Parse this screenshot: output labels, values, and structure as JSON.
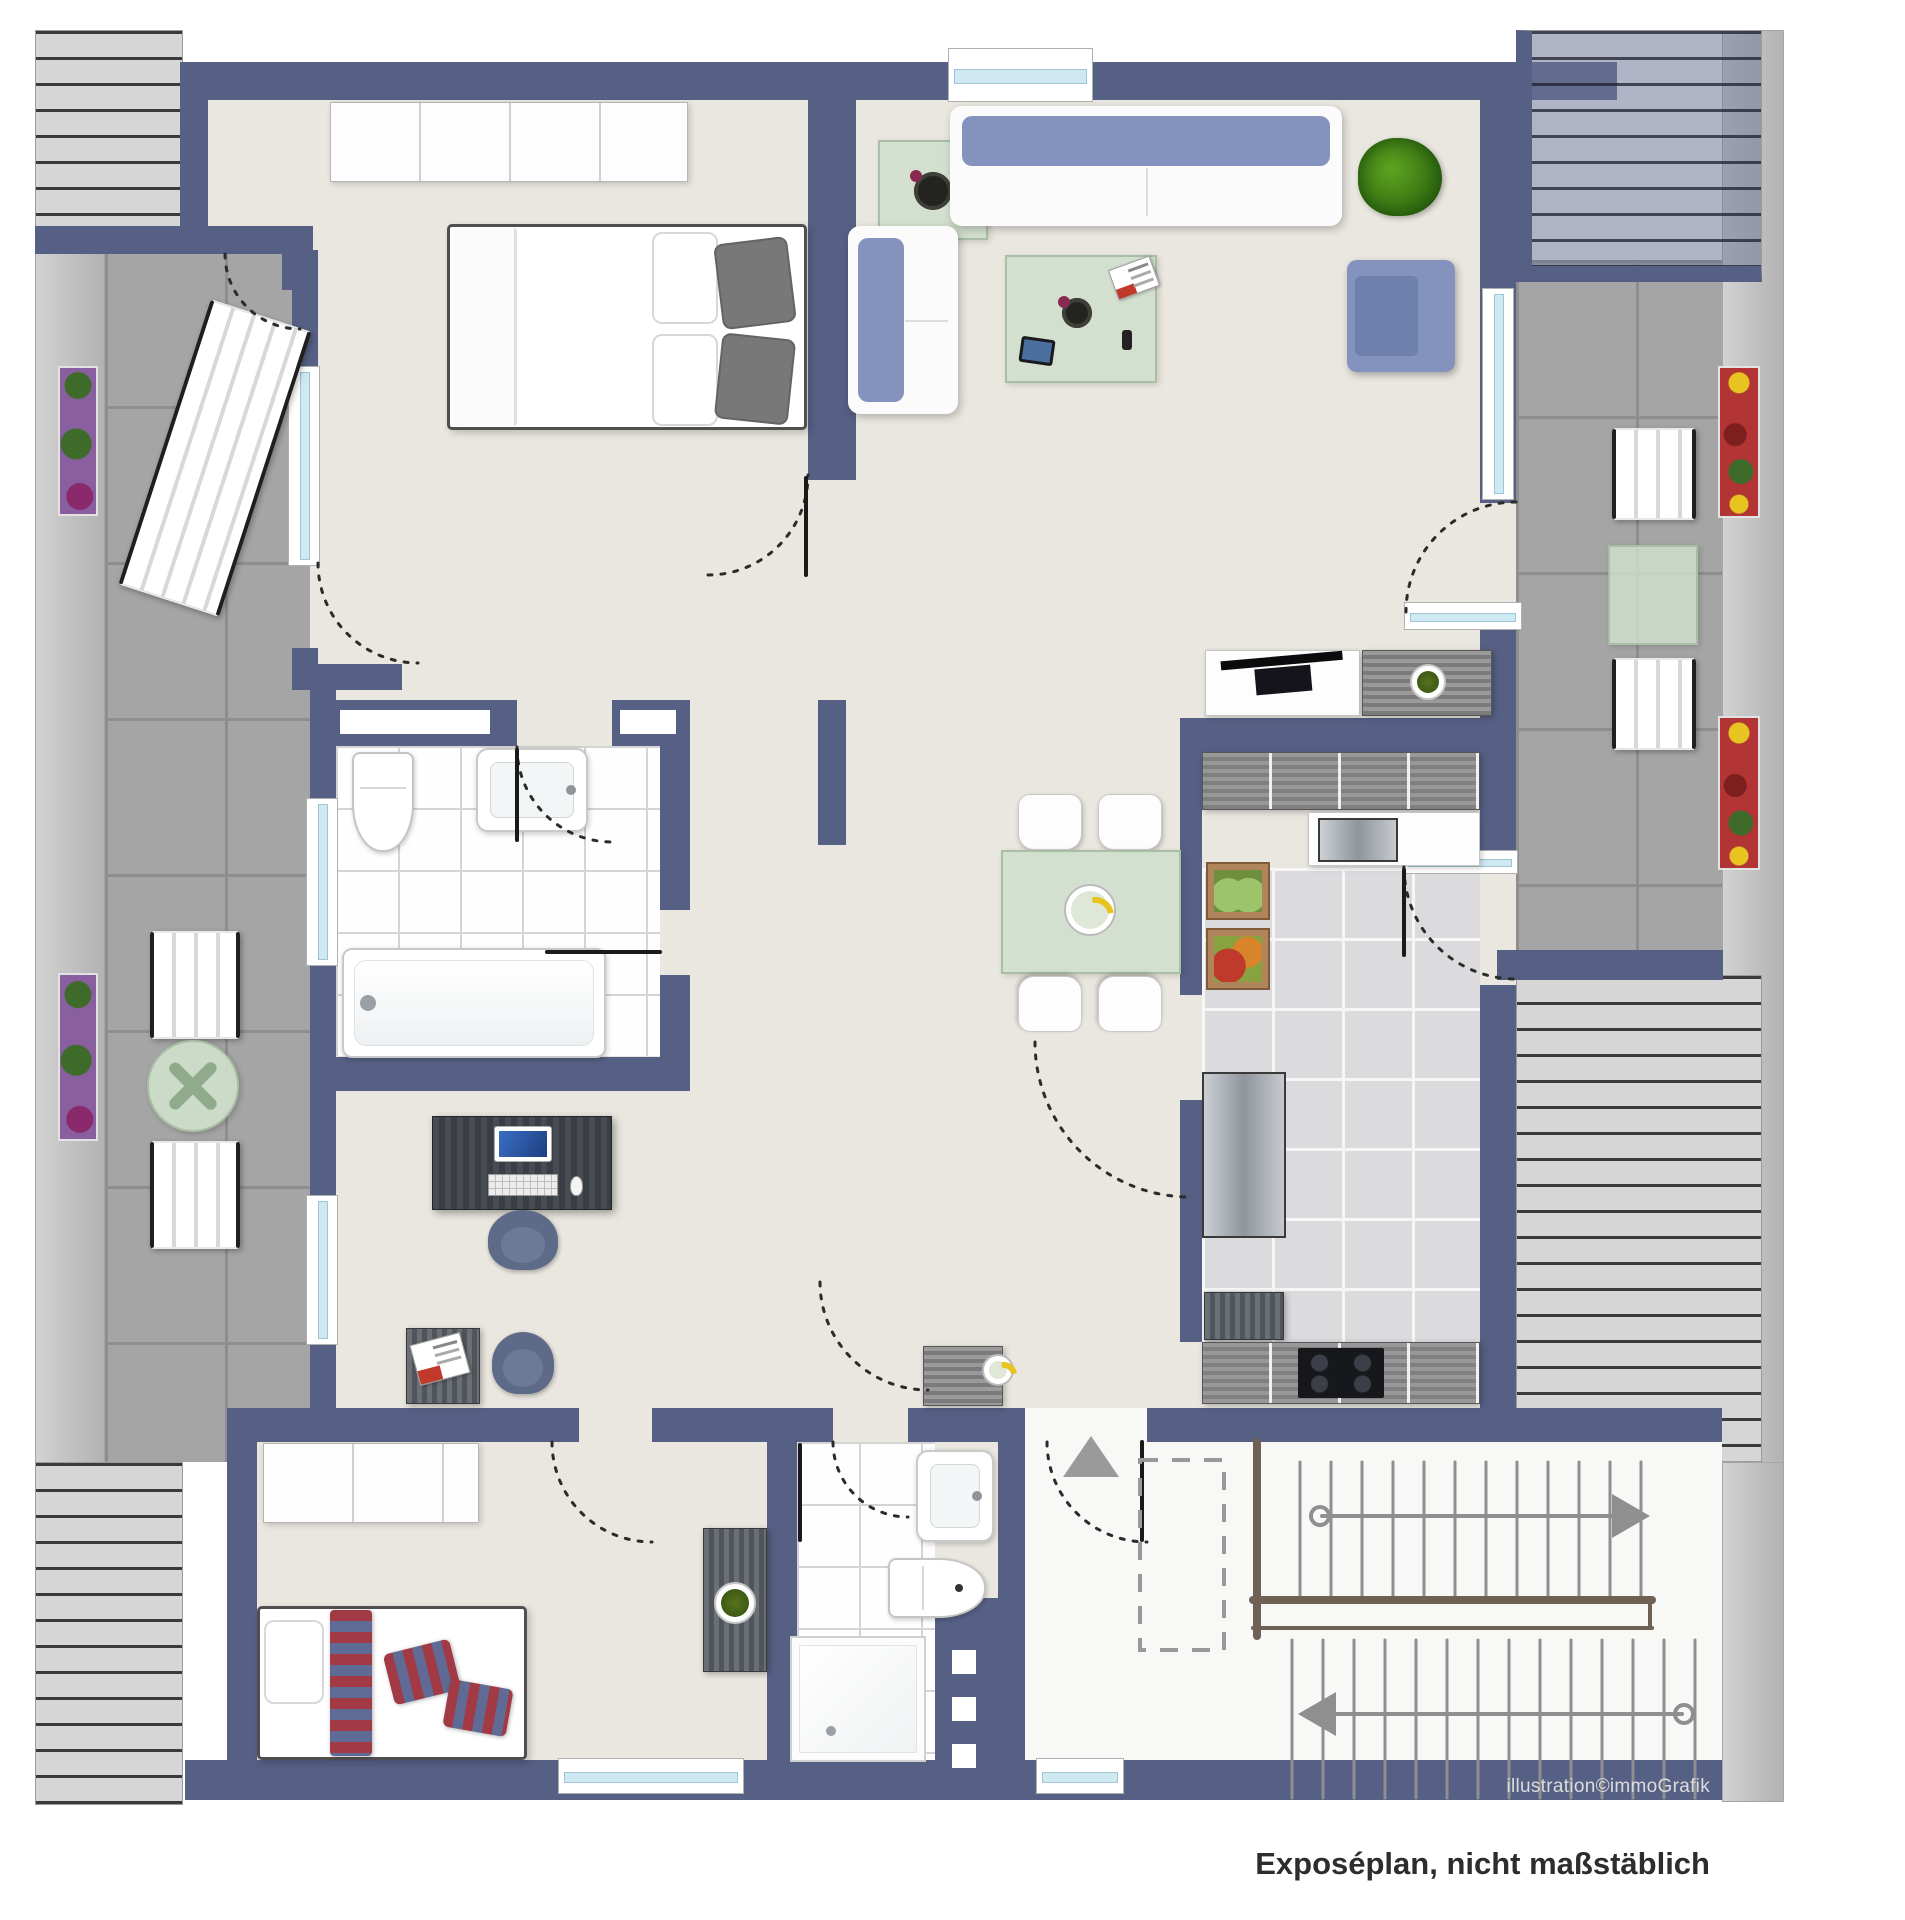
{
  "texts": {
    "credit": "illustration©immoGrafik",
    "caption": "Exposéplan, nicht maßstäblich"
  },
  "palette": {
    "wall": "#566084",
    "floor": "#eae7e0",
    "terrace_tile": "#a5a5a5",
    "roof_stripe_bg": "#d6d6d6",
    "window_glass": "#cfe9f2",
    "sofa_blue": "#8393bd",
    "glass_green": "#cfdecb",
    "accent_textile_red": "#a23a46"
  },
  "canvas": {
    "width": 1905,
    "height": 1920
  },
  "elements": [
    [
      "left-eave",
      "eave",
      35,
      30,
      70,
      1775,
      0
    ],
    [
      "right-eave",
      "eave",
      1722,
      30,
      62,
      1435,
      0
    ],
    [
      "right-eave-bottom",
      "eave",
      1722,
      1462,
      62,
      340,
      0
    ],
    [
      "left-terrace",
      "terrace",
      105,
      250,
      205,
      1212,
      0
    ],
    [
      "right-terrace",
      "terrace",
      1516,
      260,
      206,
      700,
      0
    ],
    [
      "top-left-roof",
      "roof",
      35,
      30,
      148,
      198,
      0
    ],
    [
      "bottom-left-roof",
      "roof",
      35,
      1462,
      148,
      343,
      0
    ],
    [
      "mid-right-roof",
      "roof",
      1516,
      975,
      246,
      487,
      0
    ],
    [
      "alcove-floor",
      "floor",
      185,
      100,
      125,
      130,
      0
    ],
    [
      "bedroom-floor",
      "floor",
      310,
      100,
      498,
      600,
      0
    ],
    [
      "living-floor",
      "floor",
      808,
      100,
      708,
      530,
      0
    ],
    [
      "center-floor",
      "floor",
      690,
      575,
      826,
      867,
      0
    ],
    [
      "left-wing-floor",
      "floor",
      310,
      690,
      380,
      752,
      0
    ],
    [
      "bottom-floor",
      "floor",
      227,
      1408,
      898,
      392,
      0
    ],
    [
      "entry-stair-floor",
      "floor-white",
      1010,
      1408,
      712,
      392,
      0
    ],
    [
      "bath-tiles",
      "tile-bath",
      336,
      746,
      324,
      310,
      0
    ],
    [
      "shower-tiles",
      "tile-bath",
      797,
      1442,
      138,
      318,
      0
    ],
    [
      "kitchen-tiles",
      "tile-kitchen",
      1202,
      868,
      278,
      474,
      0
    ],
    [
      "wall-top",
      "wall",
      180,
      62,
      1437,
      38,
      0
    ],
    [
      "wall-alcove-left",
      "wall",
      180,
      62,
      28,
      168,
      0
    ],
    [
      "wall-alcove-bottom",
      "wall",
      183,
      226,
      130,
      28,
      0
    ],
    [
      "wall-alcove-stub",
      "wall",
      282,
      226,
      28,
      64,
      0
    ],
    [
      "wall-roofband-tl",
      "wall",
      35,
      226,
      148,
      28,
      0
    ],
    [
      "wall-bed-left-a",
      "wall",
      292,
      250,
      26,
      118,
      0
    ],
    [
      "wall-bed-left-b",
      "wall",
      292,
      648,
      26,
      42,
      0
    ],
    [
      "wall-left-jog",
      "wall",
      292,
      664,
      110,
      26,
      0
    ],
    [
      "wall-bath-left",
      "wall",
      310,
      690,
      26,
      400,
      0
    ],
    [
      "wall-bath-top-a",
      "wall",
      310,
      700,
      207,
      46,
      0
    ],
    [
      "wall-bath-top-b",
      "wall",
      612,
      700,
      78,
      46,
      0
    ],
    [
      "wall-bath-right-a",
      "wall",
      660,
      700,
      30,
      210,
      0
    ],
    [
      "wall-bath-right-b",
      "wall",
      660,
      975,
      30,
      112,
      0
    ],
    [
      "wall-bath-bottom",
      "wall",
      310,
      1057,
      380,
      34,
      0
    ],
    [
      "wall-office-left",
      "wall",
      310,
      1057,
      26,
      385,
      0
    ],
    [
      "wall-bed-living",
      "wall",
      808,
      100,
      48,
      380,
      0
    ],
    [
      "wall-dining-stub",
      "wall",
      818,
      700,
      28,
      145,
      0
    ],
    [
      "wall-kitchen-top",
      "wall",
      1180,
      718,
      336,
      34,
      0
    ],
    [
      "wall-kitchen-left-a",
      "wall",
      1180,
      752,
      22,
      243,
      0
    ],
    [
      "wall-kitchen-left-b",
      "wall",
      1180,
      1100,
      22,
      242,
      0
    ],
    [
      "wall-right-a",
      "wall",
      1480,
      100,
      36,
      403,
      0
    ],
    [
      "wall-right-b",
      "wall",
      1480,
      612,
      36,
      256,
      0
    ],
    [
      "wall-right-c",
      "wall",
      1480,
      985,
      36,
      457,
      0
    ],
    [
      "wall-terrace-bottom",
      "wall",
      1497,
      950,
      226,
      30,
      0
    ],
    [
      "wall-stairs-top",
      "wall",
      1147,
      1408,
      575,
      34,
      0
    ],
    [
      "wall-kid-top-a",
      "wall",
      227,
      1408,
      352,
      34,
      0
    ],
    [
      "wall-kid-top-b",
      "wall",
      652,
      1408,
      145,
      34,
      0
    ],
    [
      "wall-kid-left",
      "wall",
      227,
      1408,
      30,
      360,
      0
    ],
    [
      "wall-shower-left",
      "wall",
      767,
      1408,
      30,
      392,
      0
    ],
    [
      "wall-shower-top-a",
      "wall",
      797,
      1408,
      36,
      34,
      0
    ],
    [
      "wall-shower-top-b",
      "wall",
      908,
      1408,
      102,
      34,
      0
    ],
    [
      "wall-shower-right",
      "wall",
      998,
      1408,
      27,
      200,
      0
    ],
    [
      "wall-shower-thick",
      "wall",
      935,
      1598,
      90,
      202,
      0
    ],
    [
      "wall-bottom-a",
      "wall",
      185,
      1760,
      940,
      40,
      0
    ],
    [
      "wall-bottom-b",
      "wall",
      1125,
      1760,
      597,
      40,
      0
    ],
    [
      "top-right-roof",
      "roof roof-blue",
      1516,
      30,
      246,
      252,
      0
    ],
    [
      "niche-bath-1",
      "niche",
      340,
      710,
      150,
      24,
      0
    ],
    [
      "niche-bath-2",
      "niche",
      620,
      710,
      56,
      24,
      0
    ],
    [
      "glass-block-1",
      "niche",
      952,
      1650,
      24,
      24,
      0
    ],
    [
      "glass-block-2",
      "niche",
      952,
      1697,
      24,
      24,
      0
    ],
    [
      "glass-block-3",
      "niche",
      952,
      1744,
      24,
      24,
      0
    ],
    [
      "window-top",
      "window-h",
      948,
      48,
      145,
      54,
      0
    ],
    [
      "window-bedroom",
      "window-v",
      288,
      366,
      32,
      200,
      0
    ],
    [
      "window-bath",
      "window-v",
      306,
      798,
      32,
      168,
      0
    ],
    [
      "window-office",
      "window-v",
      306,
      1195,
      32,
      150,
      0
    ],
    [
      "window-living-right",
      "window-v",
      1482,
      288,
      32,
      212,
      0
    ],
    [
      "window-living-bottom",
      "window-h",
      1404,
      602,
      118,
      28,
      0
    ],
    [
      "glass-door-kitchen",
      "window-h",
      1402,
      850,
      116,
      24,
      0
    ],
    [
      "window-kid",
      "window-h",
      558,
      1758,
      186,
      36,
      0
    ],
    [
      "window-entry",
      "window-h",
      1036,
      1758,
      88,
      36,
      0
    ],
    [
      "wardrobe-bedroom",
      "wardrobe",
      330,
      102,
      358,
      80,
      0
    ],
    [
      "double-bed",
      "bed",
      447,
      224,
      360,
      206,
      0
    ],
    [
      "double-bed-duvet",
      "duvet",
      451,
      228,
      66,
      198,
      0
    ],
    [
      "bed-pillow-white-1",
      "pillow-white",
      652,
      232,
      66,
      92,
      0
    ],
    [
      "bed-pillow-white-2",
      "pillow-white",
      652,
      334,
      66,
      92,
      0
    ],
    [
      "bed-pillow-gray-1",
      "pillow-gray",
      718,
      240,
      74,
      86,
      -7
    ],
    [
      "bed-pillow-gray-2",
      "pillow-gray",
      718,
      336,
      74,
      86,
      6
    ],
    [
      "side-table-living",
      "glass",
      878,
      140,
      110,
      100,
      0
    ],
    [
      "deco-flower",
      "deco-dark",
      914,
      172,
      38,
      38,
      0
    ],
    [
      "sofa-large",
      "sofa-h",
      950,
      106,
      392,
      120,
      0
    ],
    [
      "plant-living",
      "plant",
      1358,
      138,
      84,
      78,
      0
    ],
    [
      "sofa-small",
      "sofa-v",
      848,
      226,
      110,
      188,
      0
    ],
    [
      "coffee-table",
      "glass",
      1005,
      255,
      152,
      128,
      0
    ],
    [
      "magazine-living",
      "magazine",
      1112,
      262,
      44,
      32,
      -20
    ],
    [
      "coffee-set",
      "deco-dark",
      1062,
      298,
      30,
      30,
      0
    ],
    [
      "tablet-device",
      "tablet",
      1020,
      338,
      34,
      26,
      8
    ],
    [
      "phone-device",
      "phone",
      1122,
      330,
      10,
      20,
      0
    ],
    [
      "armchair-living",
      "armchair",
      1347,
      260,
      108,
      112,
      0
    ],
    [
      "tv-board",
      "white-box",
      1205,
      650,
      155,
      66,
      0
    ],
    [
      "tv-flatscreen",
      "tv",
      1222,
      656,
      122,
      40,
      -5
    ],
    [
      "sideboard-living",
      "wood-h",
      1362,
      650,
      130,
      66,
      0
    ],
    [
      "sideboard-plant",
      "plant-pot",
      1410,
      664,
      36,
      36,
      0
    ],
    [
      "dining-chair-1",
      "chair-white",
      1018,
      794,
      64,
      56,
      0
    ],
    [
      "dining-chair-2",
      "chair-white",
      1098,
      794,
      64,
      56,
      0
    ],
    [
      "dining-table",
      "glass",
      1001,
      850,
      180,
      124,
      0
    ],
    [
      "dining-chair-3",
      "chair-white",
      1018,
      976,
      64,
      56,
      180
    ],
    [
      "dining-chair-4",
      "chair-white",
      1098,
      976,
      64,
      56,
      180
    ],
    [
      "fruit-bowl",
      "bowl",
      1064,
      884,
      52,
      52,
      0
    ],
    [
      "kitchen-cabinets-top",
      "kcab",
      1202,
      752,
      278,
      58,
      0
    ],
    [
      "kitchen-sink-unit",
      "white-box",
      1308,
      812,
      172,
      54,
      0
    ],
    [
      "kitchen-sink",
      "steel",
      1318,
      818,
      80,
      44,
      0
    ],
    [
      "kitchen-crate-green",
      "crate-green",
      1206,
      862,
      64,
      58,
      0
    ],
    [
      "kitchen-crate-red",
      "crate-red",
      1206,
      928,
      64,
      62,
      0
    ],
    [
      "kitchen-fridge",
      "steel",
      1202,
      1072,
      84,
      166,
      0
    ],
    [
      "kitchen-cabinet-low",
      "wood-v",
      1204,
      1292,
      80,
      48,
      0
    ],
    [
      "kitchen-cabinets-bottom",
      "kcab",
      1202,
      1342,
      278,
      62,
      0
    ],
    [
      "kitchen-cooktop",
      "cooktop",
      1298,
      1348,
      86,
      50,
      0
    ],
    [
      "bath-toilet",
      "toilet",
      352,
      752,
      62,
      100,
      0
    ],
    [
      "bath-sink",
      "sink",
      476,
      748,
      112,
      84,
      0
    ],
    [
      "bathtub",
      "tub",
      342,
      948,
      264,
      110,
      0
    ],
    [
      "office-desk",
      "desk",
      432,
      1116,
      180,
      94,
      0
    ],
    [
      "desk-monitor",
      "monitor",
      494,
      1126,
      58,
      36,
      0
    ],
    [
      "desk-keyboard",
      "keyboard",
      488,
      1174,
      70,
      22,
      0
    ],
    [
      "desk-mouse",
      "mouse",
      570,
      1176,
      13,
      20,
      0
    ],
    [
      "office-chair",
      "chair-dark",
      488,
      1210,
      70,
      60,
      0
    ],
    [
      "side-table-office",
      "wood-v",
      406,
      1328,
      74,
      76,
      0
    ],
    [
      "magazine-office",
      "magazine",
      414,
      1338,
      52,
      42,
      -15
    ],
    [
      "chair-office-blue",
      "chair-dark",
      492,
      1332,
      62,
      62,
      0
    ],
    [
      "wardrobe-kid",
      "wardrobe",
      263,
      1443,
      216,
      80,
      0
    ],
    [
      "kid-bed",
      "bed",
      257,
      1606,
      270,
      154,
      0
    ],
    [
      "kid-pillow-white",
      "pillow-white",
      264,
      1620,
      60,
      84,
      0
    ],
    [
      "kid-runner-striped",
      "textile-h",
      330,
      1610,
      42,
      146,
      0
    ],
    [
      "kid-pillow-striped-1",
      "textile",
      388,
      1646,
      68,
      52,
      -14
    ],
    [
      "kid-pillow-striped-2",
      "textile",
      446,
      1684,
      64,
      48,
      10
    ],
    [
      "shower-sink",
      "sink",
      916,
      1450,
      78,
      92,
      0
    ],
    [
      "shower-toilet",
      "toilet-h",
      888,
      1558,
      98,
      60,
      0
    ],
    [
      "shower-tray",
      "shower",
      790,
      1636,
      136,
      126,
      0
    ],
    [
      "hall-cabinet",
      "wood-v",
      703,
      1528,
      64,
      144,
      0
    ],
    [
      "hall-cabinet-plant",
      "plant-pot",
      714,
      1582,
      42,
      42,
      0
    ],
    [
      "entry-commode",
      "wood-h",
      923,
      1346,
      80,
      60,
      0
    ],
    [
      "entry-dish",
      "bowl",
      982,
      1354,
      32,
      32,
      0
    ],
    [
      "planter-left-1",
      "planter-purple",
      58,
      366,
      40,
      150,
      0
    ],
    [
      "planter-left-2",
      "planter-purple",
      58,
      973,
      40,
      168,
      0
    ],
    [
      "sun-lounger",
      "slat",
      162,
      308,
      106,
      300,
      18
    ],
    [
      "terrace-chair-left-1",
      "slat",
      150,
      931,
      90,
      108,
      0
    ],
    [
      "terrace-round-table",
      "glass-round",
      147,
      1040,
      92,
      92,
      0
    ],
    [
      "terrace-chair-left-2",
      "slat",
      150,
      1141,
      90,
      108,
      0
    ],
    [
      "terrace-chair-right-1",
      "slat",
      1612,
      428,
      84,
      92,
      0
    ],
    [
      "terrace-table-right",
      "glass",
      1608,
      545,
      90,
      100,
      0
    ],
    [
      "terrace-chair-right-2",
      "slat",
      1612,
      658,
      84,
      92,
      0
    ],
    [
      "planter-right-1",
      "planter-red",
      1718,
      366,
      42,
      152,
      0
    ],
    [
      "planter-right-2",
      "planter-red",
      1718,
      716,
      42,
      154,
      0
    ]
  ],
  "vector": {
    "arc_style": {
      "color": "#2b2b2b",
      "width": 3,
      "dash": "4 9"
    },
    "arcs": [
      [
        "door-arc-alcove",
        "M225,254 A75,75 0 0 0 300,329"
      ],
      [
        "door-arc-bedroom-terrace",
        "M318,563 A100,100 0 0 0 418,663"
      ],
      [
        "door-arc-bedroom",
        "M708,575 A100,100 0 0 0 808,475"
      ],
      [
        "door-arc-living-terrace",
        "M1516,502 A110,110 0 0 0 1406,612"
      ],
      [
        "door-arc-kitchen-terrace",
        "M1404,867 A112,112 0 0 0 1516,979"
      ],
      [
        "door-arc-bath",
        "M517,747 A95,95 0 0 0 612,842"
      ],
      [
        "door-arc-hall",
        "M820,1282 A108,108 0 0 0 928,1390"
      ],
      [
        "door-arc-kitchen-hatch",
        "M1035,1042 A155,155 0 0 0 1190,1197"
      ],
      [
        "door-arc-kid",
        "M552,1442 A100,100 0 0 0 652,1542"
      ],
      [
        "door-arc-shower",
        "M833,1442 A75,75 0 0 0 908,1517"
      ],
      [
        "door-arc-entry",
        "M1047,1442 A100,100 0 0 0 1147,1542"
      ]
    ],
    "leaves": [
      [
        "door-leaf-bedroom",
        806,
        478,
        806,
        575
      ],
      [
        "door-leaf-bath",
        517,
        750,
        517,
        840
      ],
      [
        "door-leaf-shower",
        800,
        1445,
        800,
        1540
      ],
      [
        "door-leaf-kitchen",
        1404,
        870,
        1404,
        955
      ],
      [
        "door-leaf-entry",
        1142,
        1442,
        1142,
        1540
      ],
      [
        "shower-glass-tub",
        547,
        952,
        660,
        952
      ]
    ],
    "stairs": {
      "tread_color": "#8f8f8f",
      "flight1": {
        "x0": 1300,
        "n": 12,
        "step": 31,
        "y1": 1462,
        "y2": 1596
      },
      "flight2": {
        "x0": 1292,
        "n": 14,
        "step": 31,
        "y1": 1640,
        "y2": 1798
      },
      "stringer_color": "#6f6154",
      "stringer": [
        [
          1257,
          1442,
          1257,
          1636,
          8
        ],
        [
          1253,
          1600,
          1652,
          1600,
          8
        ],
        [
          1253,
          1628,
          1652,
          1628,
          4
        ],
        [
          1650,
          1600,
          1650,
          1628,
          4
        ]
      ],
      "arrow_up": {
        "line": [
          1322,
          1516,
          1612,
          1516
        ],
        "circle": [
          1320,
          1516,
          9
        ],
        "head": "1612,1494 1650,1516 1612,1538"
      },
      "arrow_down": {
        "line": [
          1336,
          1714,
          1682,
          1714
        ],
        "circle": [
          1684,
          1714,
          9
        ],
        "head": "1336,1692 1298,1714 1336,1736"
      },
      "void_rect": [
        1140,
        1460,
        84,
        190
      ],
      "entry_marker_triangle": "1063,1477 1091,1436 1119,1477",
      "marker_color": "#9a9a9a"
    }
  }
}
